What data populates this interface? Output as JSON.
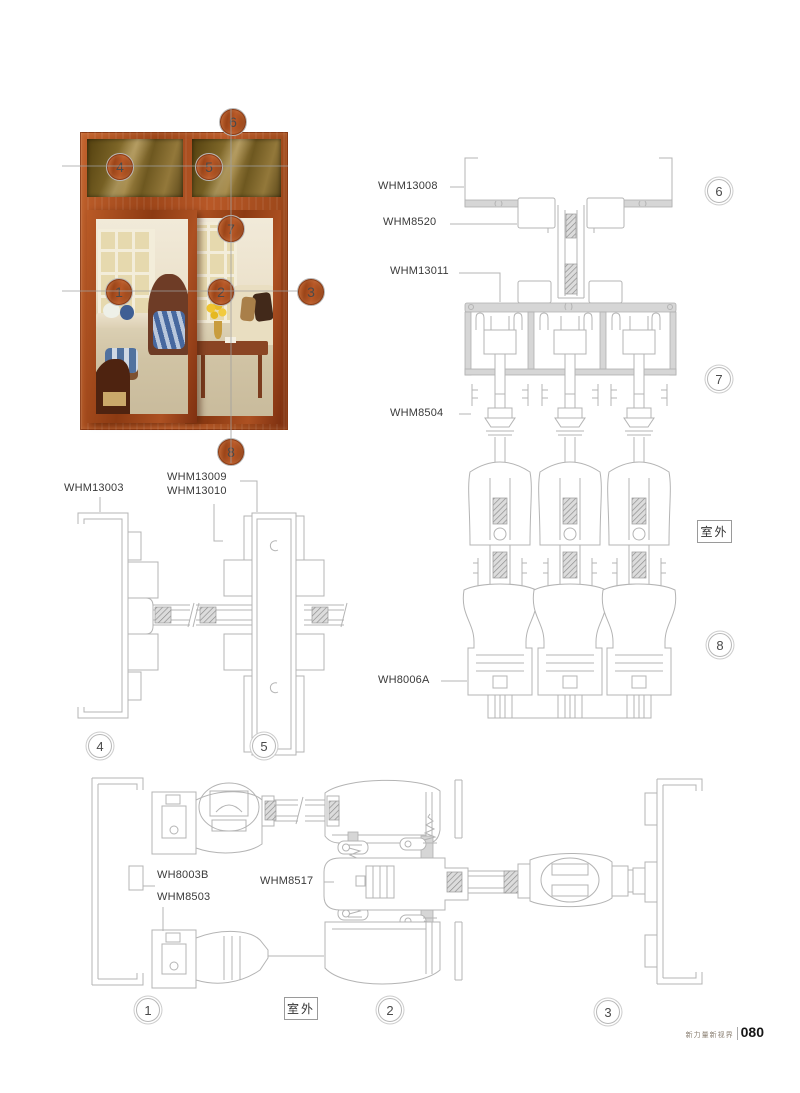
{
  "callouts": {
    "photo": {
      "c1": "1",
      "c2": "2",
      "c3": "3",
      "c4": "4",
      "c5": "5",
      "c6": "6",
      "c7": "7",
      "c8": "8"
    },
    "diagram": {
      "d1": "1",
      "d2": "2",
      "d3": "3",
      "d4": "4",
      "d5": "5",
      "d6": "6",
      "d7": "7",
      "d8": "8"
    }
  },
  "labels": {
    "whm13008": "WHM13008",
    "whm8520": "WHM8520",
    "whm13011": "WHM13011",
    "whm8504": "WHM8504",
    "wh8006a": "WH8006A",
    "whm13003": "WHM13003",
    "whm13009": "WHM13009",
    "whm13010": "WHM13010",
    "wh8003b": "WH8003B",
    "whm8503": "WHM8503",
    "whm8517": "WHM8517"
  },
  "outdoor_labels": {
    "right": "室外",
    "bottom": "室外"
  },
  "footer": {
    "slogan": "新力量新视界",
    "page_number": "080"
  }
}
